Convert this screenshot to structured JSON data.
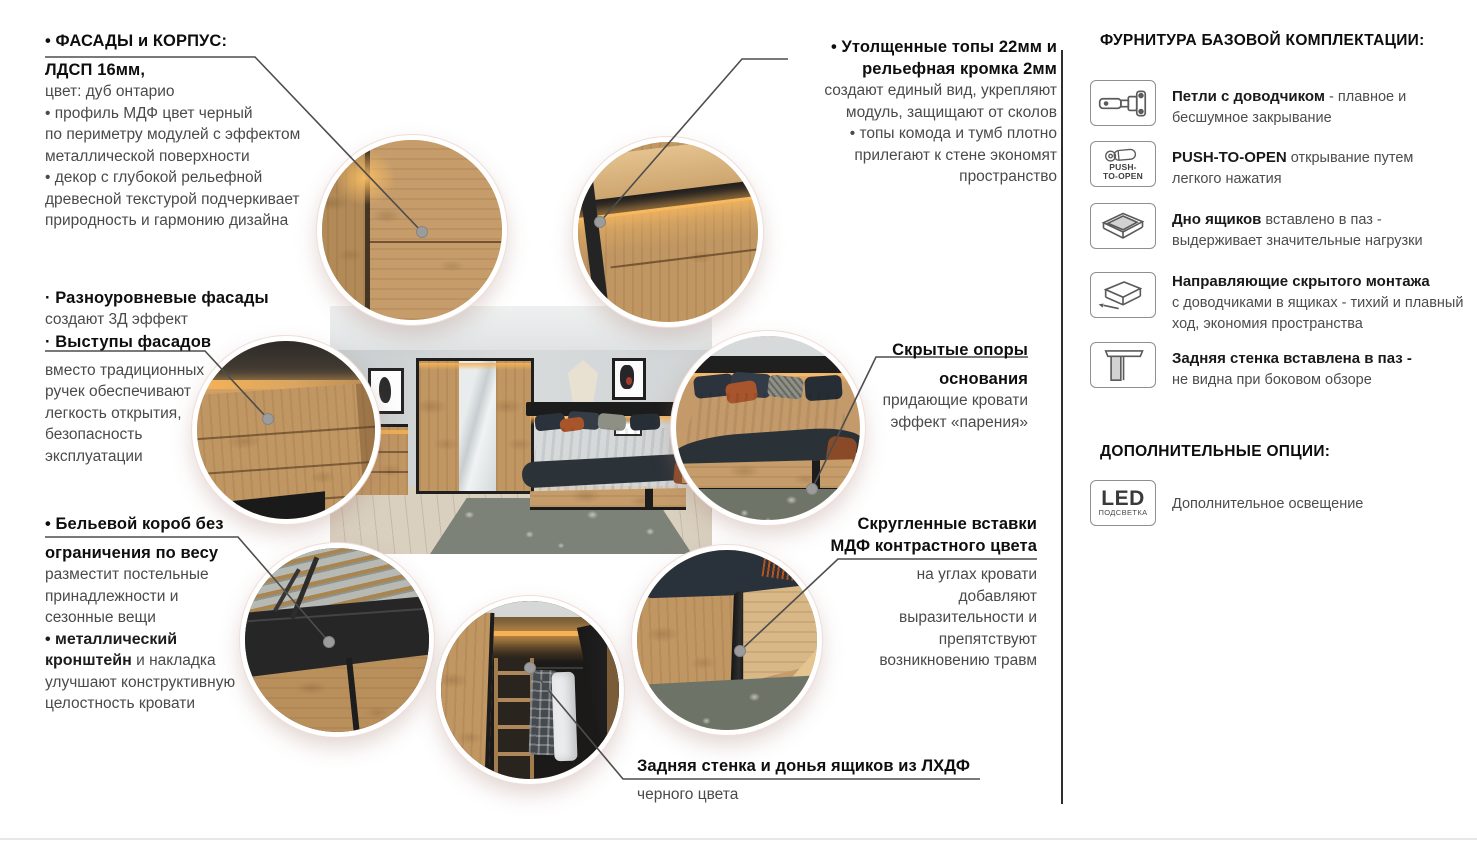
{
  "annotations": {
    "facades": {
      "t1": "• ФАСАДЫ и КОРПУС:",
      "t2": "ЛДСП 16мм,",
      "l": [
        "цвет: дуб онтарио",
        "• профиль МДФ цвет черный",
        "по периметру модулей с эффектом",
        "металлической поверхности",
        "• декор с глубокой рельефной",
        "древесной текстурой подчеркивает",
        "природность и гармонию дизайна"
      ]
    },
    "tops": {
      "t1": "• Утолщенные топы 22мм и",
      "t2": "рельефная кромка 2мм",
      "l": [
        "создают единый вид, укрепляют",
        "модуль, защищают от сколов",
        "• топы комода и тумб плотно",
        "прилегают к стене экономят",
        "пространство"
      ]
    },
    "levels": {
      "t1": "· Разноуровневые фасады",
      "l1": "создают 3Д эффект",
      "t2": "· Выступы фасадов",
      "l": [
        "вместо традиционных",
        "ручек обеспечивают",
        "легкость открытия,",
        "безопасность",
        "эксплуатации"
      ]
    },
    "supports": {
      "t1": "Скрытые опоры",
      "t2": "основания",
      "l": [
        "придающие кровати",
        "эффект «парения»"
      ]
    },
    "linenbox": {
      "t1": "• Бельевой короб без",
      "t2": "ограничения по весу",
      "l": [
        "разместит постельные",
        "принадлежности и",
        "сезонные вещи"
      ],
      "m1": "• металлический",
      "m2b": "кронштейн",
      "m2r": " и накладка",
      "l2": [
        "улучшают конструктивную",
        "целостность кровати"
      ]
    },
    "inserts": {
      "t1": "Скругленные вставки",
      "t2": "МДФ контрастного цвета",
      "l": [
        "на углах кровати",
        "добавляют",
        "выразительности и",
        "препятствуют",
        "возникновению травм"
      ]
    },
    "back": {
      "t": "Задняя стенка и донья ящиков из ЛХДФ",
      "l": "черного цвета"
    }
  },
  "sidebar": {
    "h1": "ФУРНИТУРА БАЗОВОЙ КОМПЛЕКТАЦИИ:",
    "items": [
      {
        "bold": "Петли с доводчиком",
        "after": " - плавное и",
        "line2": "бесшумное закрывание"
      },
      {
        "bold": "PUSH-TO-OPEN",
        "after": " открывание путем",
        "line2": "легкого нажатия"
      },
      {
        "bold": "Дно ящиков",
        "after": " вставлено в паз -",
        "line2": "выдерживает значительные нагрузки"
      },
      {
        "bold": "Направляющие скрытого монтажа",
        "after": "",
        "line2": "с доводчиками в ящиках - тихий и плавный",
        "line3": "ход, экономия пространства"
      },
      {
        "bold": "Задняя стенка вставлена в паз -",
        "after": "",
        "line2": "не видна при боковом обзоре"
      }
    ],
    "h2": "ДОПОЛНИТЕЛЬНЫЕ ОПЦИИ:",
    "option_text": "Дополнительное освещение",
    "push1": "PUSH-",
    "push2": "TO-OPEN",
    "led": "LED",
    "led_sub": "ПОДСВЕТКА"
  },
  "colors": {
    "accent_led": "#f2a54c",
    "wood": "#c49a6a",
    "black_trim": "#1d1d1d",
    "body_text": "#4a4a4a",
    "title_text": "#0e0e0e",
    "divider": "#2e2e2e",
    "circle_ring": "#ffffff",
    "rug": "#6f7468",
    "bedding_dark": "#2b3237",
    "blanket_terracotta": "#a65e38"
  }
}
